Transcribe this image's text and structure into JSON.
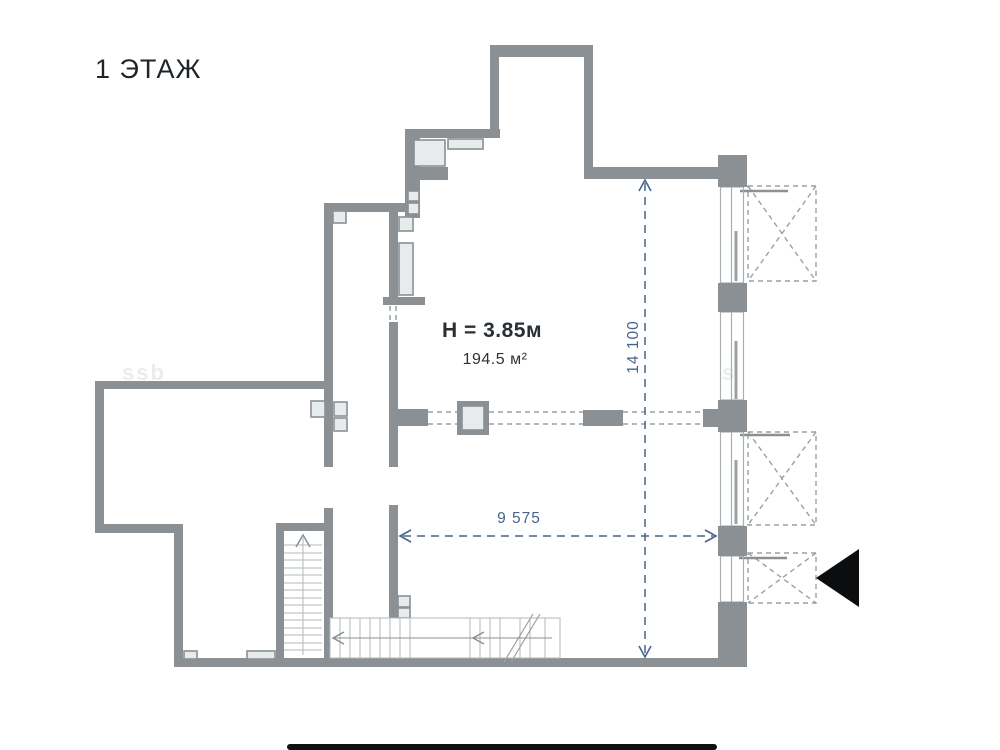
{
  "page": {
    "floor_title": "1 ЭТАЖ",
    "background": "#ffffff"
  },
  "plan": {
    "ceiling_height_label": "H = 3.85м",
    "area_label": "194.5 м²",
    "dim_vertical": "14 100",
    "dim_horizontal": "9 575",
    "watermark_left": "ssb",
    "watermark_right": "s",
    "colors": {
      "wall": "#8a9094",
      "light_fill": "#e8ebeb",
      "thin_line": "#a9aeb0",
      "stair_line": "#b3b8ba",
      "balcony_dash": "#9aa0a3",
      "dimension_blue": "#46648c",
      "entrance_marker": "#0c0d0f",
      "title_text": "#1f2428"
    }
  }
}
